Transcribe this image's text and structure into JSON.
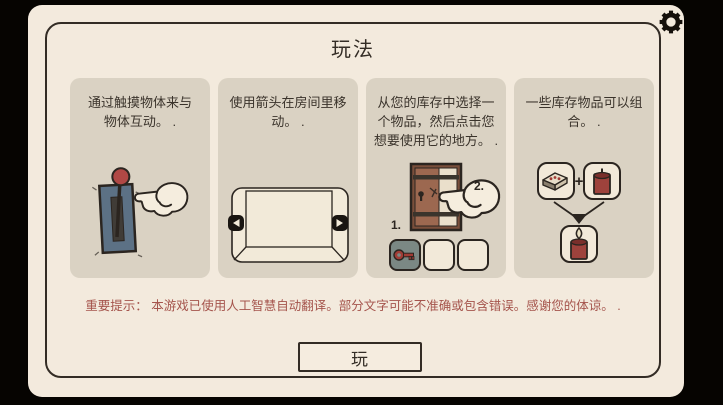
{
  "title": "玩法",
  "settings": {
    "icon": "gear-icon"
  },
  "panels": [
    {
      "lines": [
        "通过触摸物体来与",
        "物体互动。 ."
      ]
    },
    {
      "lines": [
        "使用箭头在房间里移",
        "动。 ."
      ]
    },
    {
      "lines": [
        "从您的库存中选择一",
        "个物品，然后点击您",
        "想要使用它的地方。 ."
      ],
      "step1": "1.",
      "step2": "2."
    },
    {
      "lines": [
        "一些库存物品可以组",
        "合。 ."
      ],
      "plus": "+"
    }
  ],
  "warning": "重要提示： 本游戏已使用人工智慧自动翻译。部分文字可能不准确或包含错误。感谢您的体谅。 .",
  "play_button": "玩",
  "colors": {
    "screen_bg": "#f3eadd",
    "panel_bg": "#dad2c3",
    "ink": "#332c25",
    "warning_text": "#a5544c",
    "accent_red": "#a8423d",
    "lever_plate_blue": "#5c7185",
    "door_brown": "#9c6850"
  }
}
